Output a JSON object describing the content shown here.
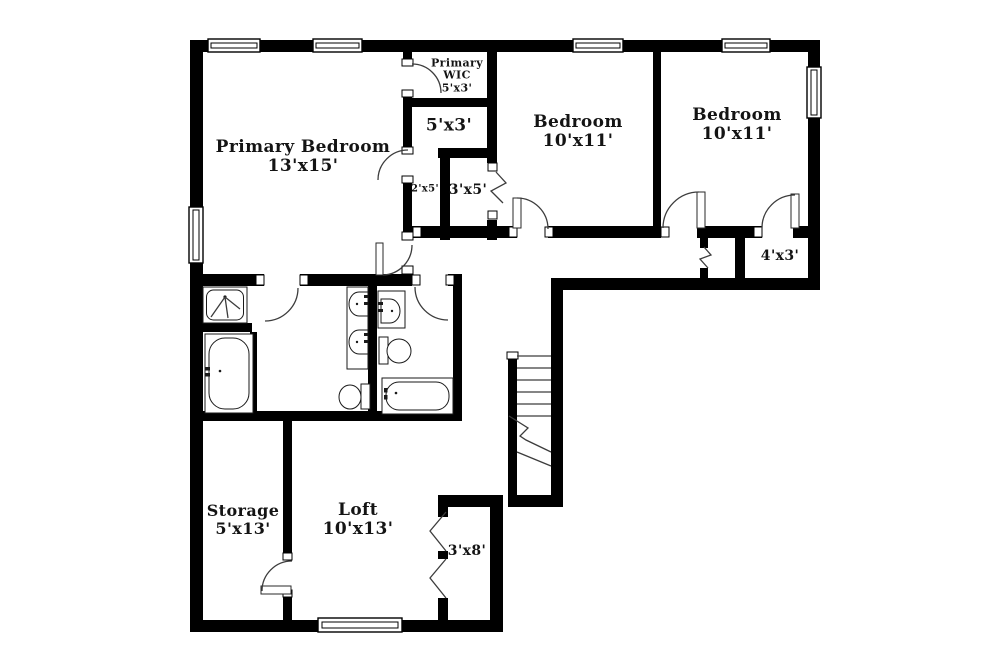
{
  "floorplan": {
    "colors": {
      "wall": "#000000",
      "line": "#3c3c3c",
      "background": "#ffffff",
      "text": "#141414"
    },
    "rooms": {
      "primary_bedroom": {
        "name": "Primary Bedroom",
        "dims": "13'x15'"
      },
      "primary_wic": {
        "name": "Primary WIC",
        "dims": "5'x3'"
      },
      "closet_5x3": {
        "name": "",
        "dims": "5'x3'"
      },
      "hall_2x5": {
        "name": "",
        "dims": "2'x5'"
      },
      "closet_3x5": {
        "name": "",
        "dims": "3'x5'"
      },
      "bedroom_left": {
        "name": "Bedroom",
        "dims": "10'x11'"
      },
      "bedroom_right": {
        "name": "Bedroom",
        "dims": "10'x11'"
      },
      "closet_4x3": {
        "name": "",
        "dims": "4'x3'"
      },
      "storage": {
        "name": "Storage",
        "dims": "5'x13'"
      },
      "loft": {
        "name": "Loft",
        "dims": "10'x13'"
      },
      "closet_3x8": {
        "name": "",
        "dims": "3'x8'"
      }
    },
    "fixtures": [
      "shower",
      "bathtub",
      "bathtub",
      "double-vanity-sinks",
      "sink",
      "toilet",
      "toilet",
      "staircase",
      "window",
      "door",
      "accordion-door"
    ]
  }
}
